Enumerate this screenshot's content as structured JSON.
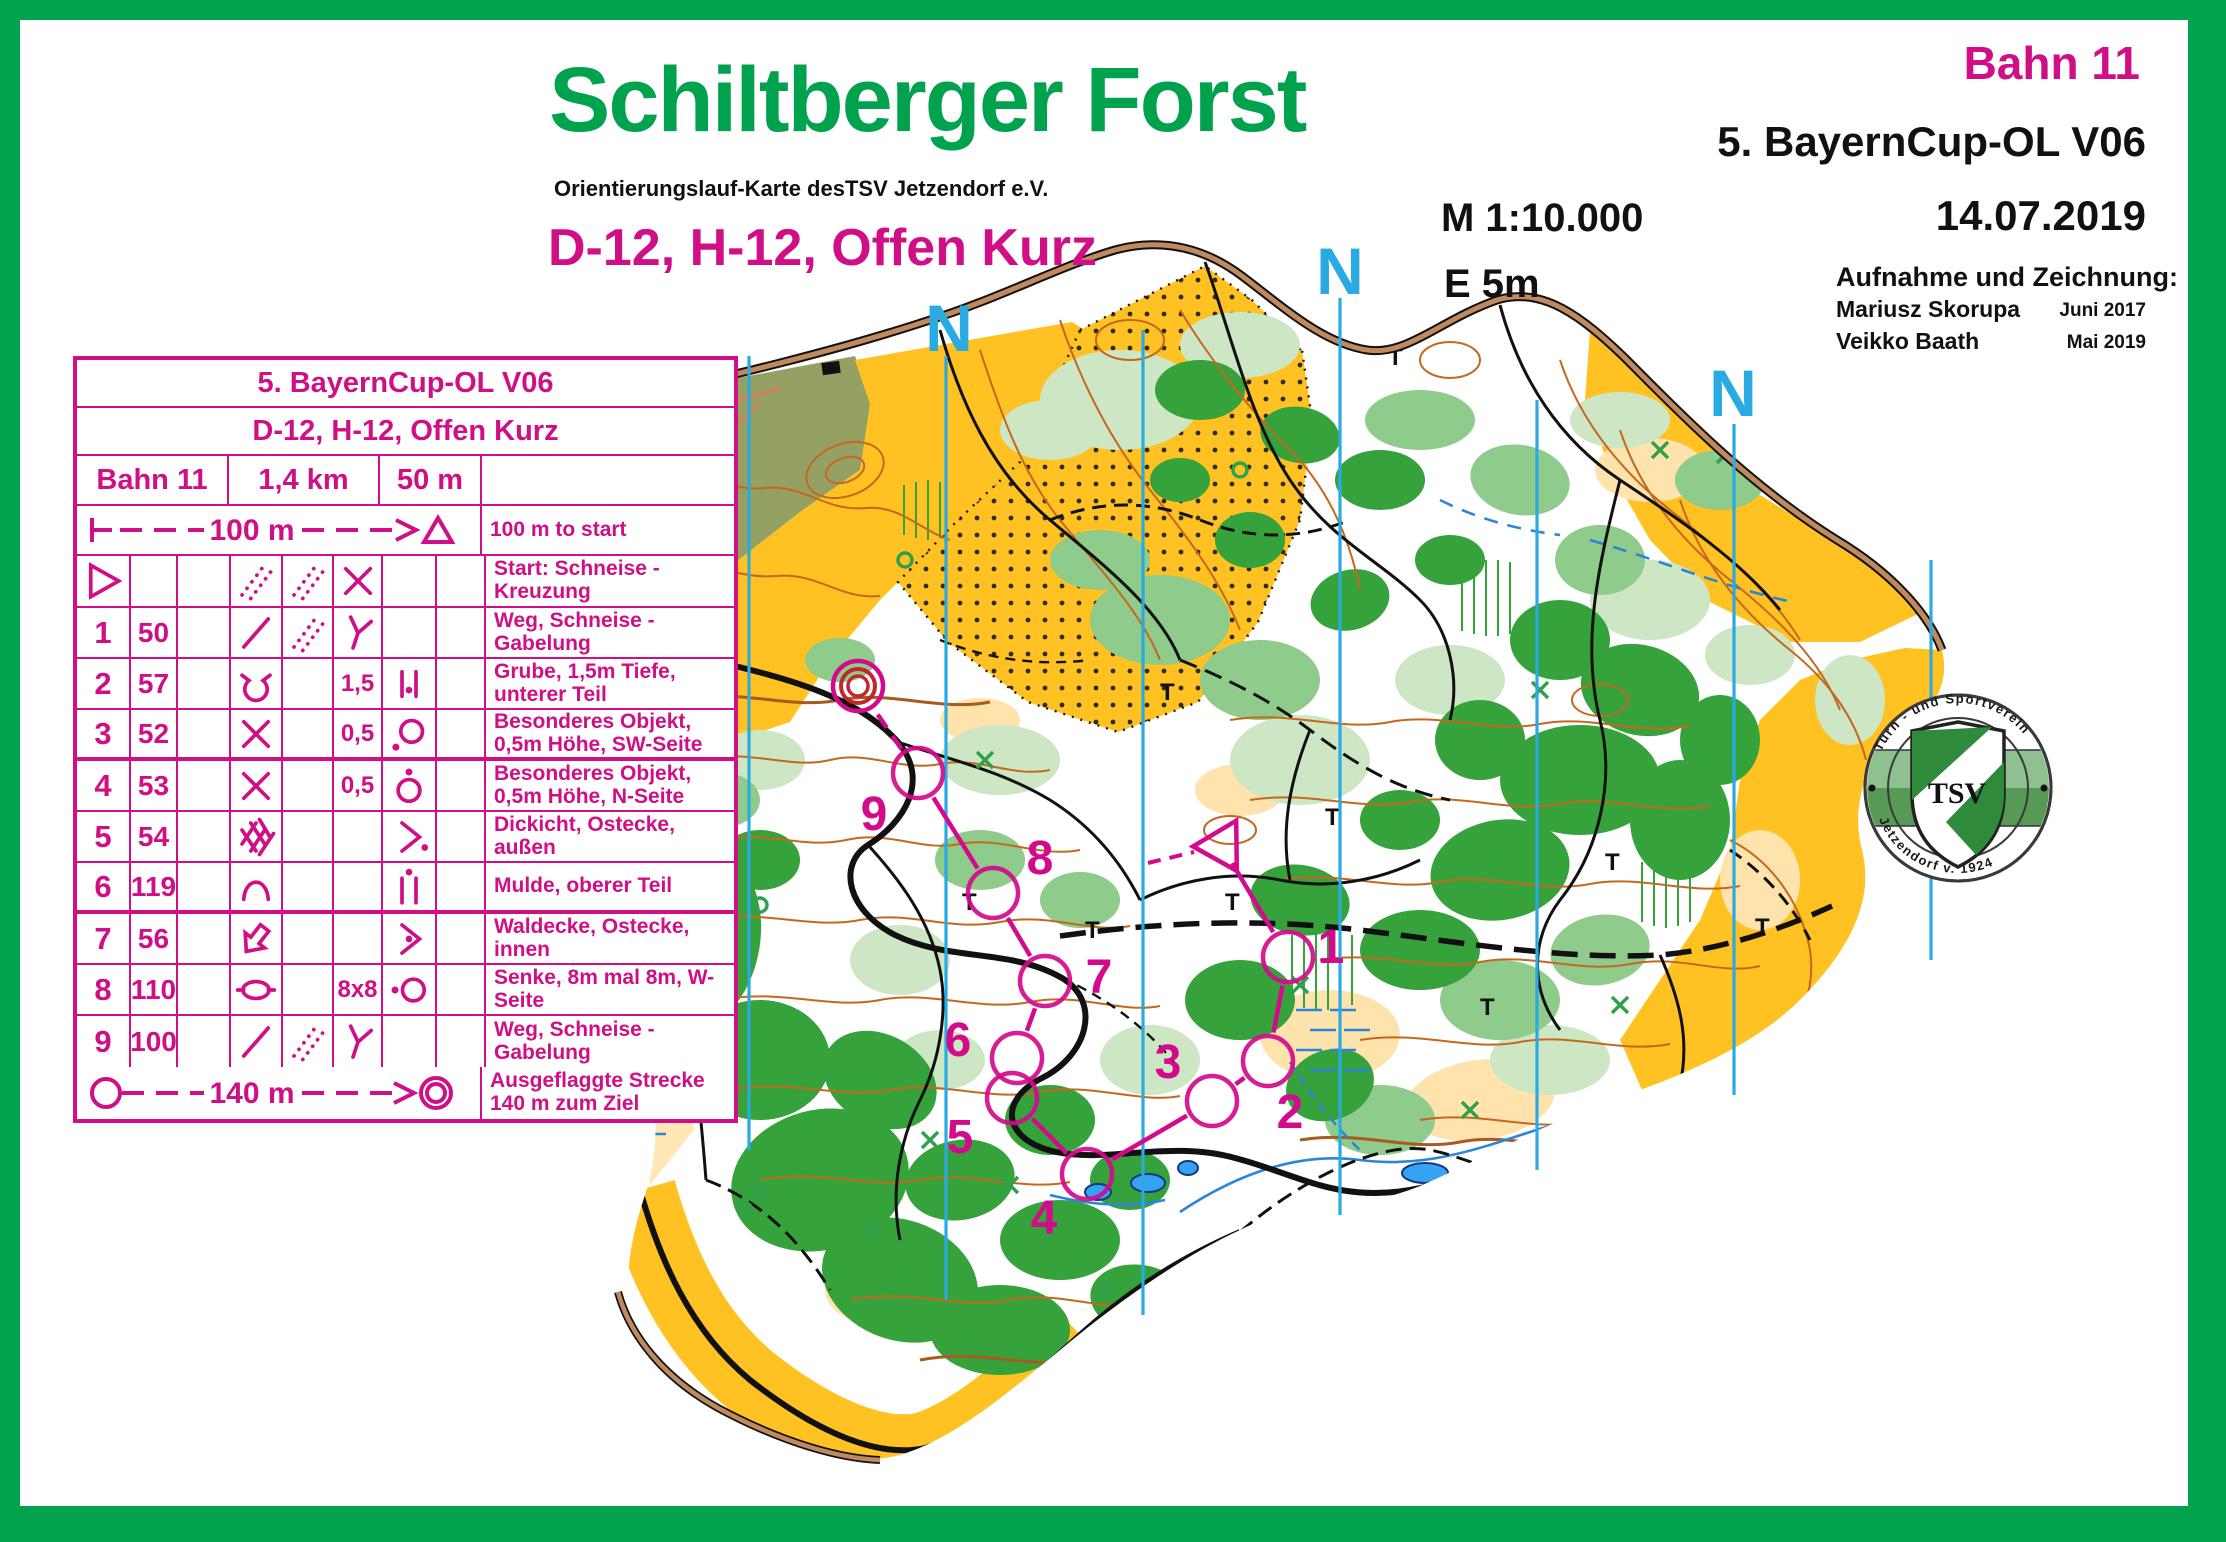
{
  "header": {
    "title": "Schiltberger Forst",
    "subtitle": "Orientierungslauf-Karte desTSV Jetzendorf e.V.",
    "class_line": "D-12, H-12, Offen Kurz",
    "course_label": "Bahn 11",
    "event": "5. BayernCup-OL V06",
    "date": "14.07.2019",
    "scale": "M 1:10.000",
    "equidistance": "E 5m",
    "credits_heading": "Aufnahme und Zeichnung:",
    "credits": [
      {
        "name": "Mariusz Skorupa",
        "date": "Juni 2017"
      },
      {
        "name": "Veikko Baath",
        "date": "Mai 2019"
      }
    ]
  },
  "card": {
    "title": "5. BayernCup-OL V06",
    "class_line": "D-12, H-12, Offen Kurz",
    "course_name": "Bahn 11",
    "length": "1,4 km",
    "climb": "50 m",
    "scale_row": {
      "label": "100 m",
      "desc": "100 m to start"
    },
    "start_row": {
      "symbols": {
        "a": "tri",
        "d": "ride",
        "e": "ride",
        "f": "cross"
      },
      "desc": "Start: Schneise - Kreuzung"
    },
    "rows": [
      {
        "num": "1",
        "code": "50",
        "d": "slash",
        "e": "ride",
        "f": "fork",
        "g": "",
        "desc": "Weg, Schneise - Gabelung"
      },
      {
        "num": "2",
        "code": "57",
        "d": "pit",
        "e": "",
        "f": "1,5",
        "g": "bars-dot",
        "desc": "Grube, 1,5m Tiefe, unterer Teil"
      },
      {
        "num": "3",
        "code": "52",
        "d": "cross",
        "e": "",
        "f": "0,5",
        "g": "circle-dot-sw",
        "desc": "Besonderes Objekt, 0,5m Höhe, SW-Seite"
      },
      {
        "num": "4",
        "code": "53",
        "d": "cross",
        "e": "",
        "f": "0,5",
        "g": "circle-dot-n",
        "desc": "Besonderes Objekt, 0,5m Höhe, N-Seite"
      },
      {
        "num": "5",
        "code": "54",
        "d": "thicket",
        "e": "",
        "f": "",
        "g": "angle-dot-out",
        "desc": "Dickicht, Ostecke, außen"
      },
      {
        "num": "6",
        "code": "119",
        "d": "mulde",
        "e": "",
        "f": "",
        "g": "bars-dot-top",
        "desc": "Mulde, oberer Teil"
      },
      {
        "num": "7",
        "code": "56",
        "d": "corner",
        "e": "",
        "f": "",
        "g": "angle-dot-in",
        "desc": "Waldecke, Ostecke, innen"
      },
      {
        "num": "8",
        "code": "110",
        "d": "senke",
        "e": "",
        "f": "8x8",
        "g": "circle-dot-w",
        "desc": "Senke, 8m mal 8m, W-Seite"
      },
      {
        "num": "9",
        "code": "100",
        "d": "slash",
        "e": "ride",
        "f": "fork",
        "g": "",
        "desc": "Weg, Schneise - Gabelung"
      }
    ],
    "finish_row": {
      "label": "140 m",
      "desc": "Ausgeflaggte Strecke 140 m zum Ziel"
    }
  },
  "map": {
    "north_label": "N",
    "course_overlay": {
      "start": {
        "x": 1222,
        "y": 846
      },
      "controls": [
        {
          "n": "1",
          "x": 1288,
          "y": 957,
          "lx": 1331,
          "ly": 947
        },
        {
          "n": "2",
          "x": 1268,
          "y": 1061,
          "lx": 1290,
          "ly": 1112
        },
        {
          "n": "3",
          "x": 1212,
          "y": 1101,
          "lx": 1168,
          "ly": 1062
        },
        {
          "n": "4",
          "x": 1087,
          "y": 1174,
          "lx": 1044,
          "ly": 1218
        },
        {
          "n": "5",
          "x": 1012,
          "y": 1098,
          "lx": 960,
          "ly": 1137
        },
        {
          "n": "6",
          "x": 1017,
          "y": 1058,
          "lx": 958,
          "ly": 1040
        },
        {
          "n": "7",
          "x": 1045,
          "y": 981,
          "lx": 1099,
          "ly": 977
        },
        {
          "n": "8",
          "x": 993,
          "y": 893,
          "lx": 1040,
          "ly": 858
        },
        {
          "n": "9",
          "x": 918,
          "y": 773,
          "lx": 874,
          "ly": 814
        }
      ],
      "finish": {
        "x": 858,
        "y": 686
      }
    },
    "logo": {
      "ring_top": "Turn - und Sportverein",
      "ring_bottom": "Jetzendorf v. 1924",
      "shield": "TSV"
    }
  }
}
